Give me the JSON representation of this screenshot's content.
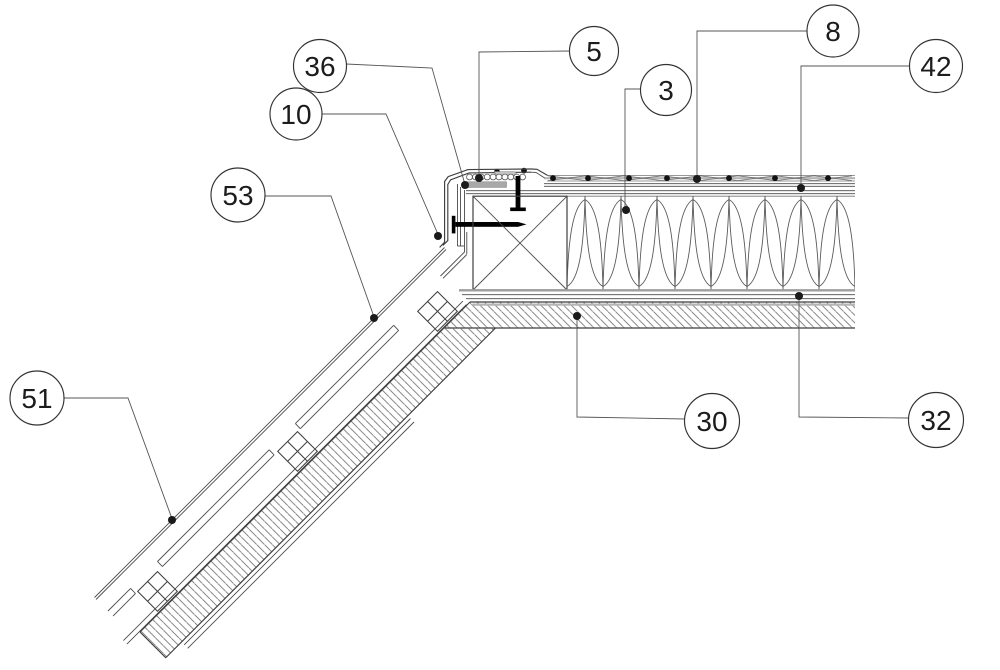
{
  "drawing": {
    "background": "#ffffff",
    "line_color": "#3f3f3f",
    "leader_color": "#555555",
    "hatch_color": "#6f6f6f",
    "gasket_color": "#a8a8a8",
    "dot_radius": 4
  },
  "callouts": [
    {
      "label": "5",
      "circle": {
        "cx": 594,
        "cy": 51,
        "r": 24.5
      },
      "leader": [
        [
          570,
          51
        ],
        [
          479,
          52
        ],
        [
          479,
          174
        ]
      ],
      "dot": [
        479,
        178
      ]
    },
    {
      "label": "36",
      "circle": {
        "cx": 320,
        "cy": 66,
        "r": 26.5
      },
      "leader": [
        [
          346,
          64
        ],
        [
          432,
          68
        ],
        [
          464,
          181
        ]
      ],
      "dot": [
        465,
        185
      ]
    },
    {
      "label": "10",
      "circle": {
        "cx": 296,
        "cy": 114,
        "r": 26
      },
      "leader": [
        [
          322,
          114
        ],
        [
          386,
          114
        ],
        [
          437,
          232
        ]
      ],
      "dot": [
        438,
        236
      ]
    },
    {
      "label": "53",
      "circle": {
        "cx": 238,
        "cy": 195,
        "r": 27
      },
      "leader": [
        [
          265,
          196
        ],
        [
          331,
          196
        ],
        [
          373,
          314
        ]
      ],
      "dot": [
        374,
        318
      ]
    },
    {
      "label": "51",
      "circle": {
        "cx": 37,
        "cy": 398,
        "r": 27
      },
      "leader": [
        [
          64,
          398
        ],
        [
          128,
          398
        ],
        [
          171,
          516
        ]
      ],
      "dot": [
        172,
        520
      ]
    },
    {
      "label": "3",
      "circle": {
        "cx": 666,
        "cy": 90,
        "r": 25.5
      },
      "leader": [
        [
          641,
          89
        ],
        [
          625,
          89
        ],
        [
          625,
          206
        ]
      ],
      "dot": [
        626,
        210
      ]
    },
    {
      "label": "8",
      "circle": {
        "cx": 833,
        "cy": 31,
        "r": 26
      },
      "leader": [
        [
          807,
          31
        ],
        [
          697,
          31
        ],
        [
          697,
          175
        ]
      ],
      "dot": [
        697,
        179
      ]
    },
    {
      "label": "42",
      "circle": {
        "cx": 936,
        "cy": 66,
        "r": 26.5
      },
      "leader": [
        [
          910,
          66
        ],
        [
          801,
          66
        ],
        [
          801,
          184
        ]
      ],
      "dot": [
        801,
        188
      ]
    },
    {
      "label": "30",
      "circle": {
        "cx": 712,
        "cy": 421,
        "r": 27.5
      },
      "leader": [
        [
          685,
          419
        ],
        [
          577,
          417
        ],
        [
          577,
          320
        ]
      ],
      "dot": [
        577,
        316
      ]
    },
    {
      "label": "32",
      "circle": {
        "cx": 936,
        "cy": 420,
        "r": 27.5
      },
      "leader": [
        [
          909,
          418
        ],
        [
          799,
          417
        ],
        [
          799,
          300
        ]
      ],
      "dot": [
        799,
        296
      ]
    }
  ]
}
